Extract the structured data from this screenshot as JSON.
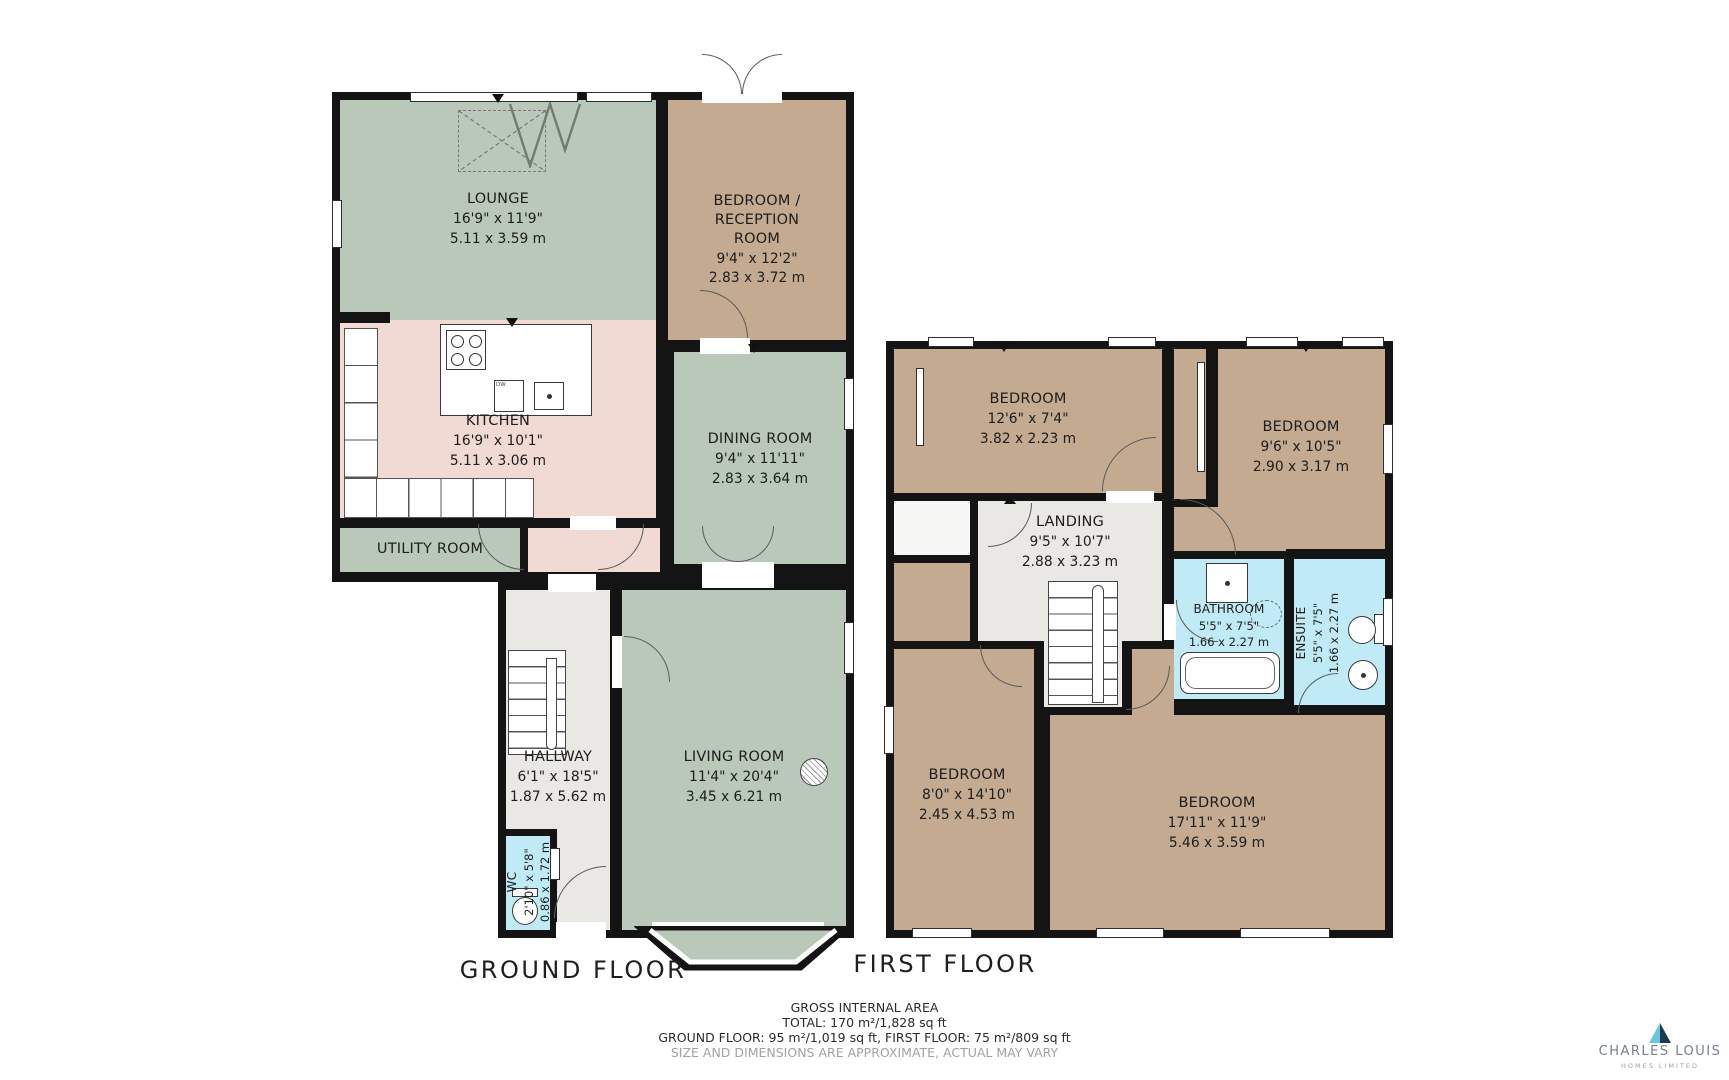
{
  "ground": {
    "floor_label": "GROUND FLOOR",
    "rooms": [
      {
        "name": "LOUNGE",
        "ft": "16'9\" x 11'9\"",
        "m": "5.11 x 3.59 m"
      },
      {
        "name": "BEDROOM / RECEPTION ROOM",
        "ft": "9'4\" x 12'2\"",
        "m": "2.83 x 3.72 m"
      },
      {
        "name": "KITCHEN",
        "ft": "16'9\" x 10'1\"",
        "m": "5.11 x 3.06 m"
      },
      {
        "name": "DINING ROOM",
        "ft": "9'4\" x 11'11\"",
        "m": "2.83 x 3.64 m"
      },
      {
        "name": "UTILITY ROOM",
        "ft": "",
        "m": ""
      },
      {
        "name": "HALLWAY",
        "ft": "6'1\" x 18'5\"",
        "m": "1.87 x 5.62 m"
      },
      {
        "name": "WC",
        "ft": "2'10\" x 5'8\"",
        "m": "0.86 x 1.72 m"
      },
      {
        "name": "LIVING ROOM",
        "ft": "11'4\" x 20'4\"",
        "m": "3.45 x 6.21 m"
      }
    ]
  },
  "first": {
    "floor_label": "FIRST FLOOR",
    "rooms": [
      {
        "name": "BEDROOM",
        "ft": "12'6\" x 7'4\"",
        "m": "3.82 x 2.23 m"
      },
      {
        "name": "BEDROOM",
        "ft": "9'6\" x 10'5\"",
        "m": "2.90 x 3.17 m"
      },
      {
        "name": "LANDING",
        "ft": "9'5\" x 10'7\"",
        "m": "2.88 x 3.23 m"
      },
      {
        "name": "BATHROOM",
        "ft": "5'5\" x 7'5\"",
        "m": "1.66 x 2.27 m"
      },
      {
        "name": "ENSUITE",
        "ft": "5'5\" x 7'5\"",
        "m": "1.66 x 2.27 m"
      },
      {
        "name": "BEDROOM",
        "ft": "8'0\" x 14'10\"",
        "m": "2.45 x 4.53 m"
      },
      {
        "name": "BEDROOM",
        "ft": "17'11\" x 11'9\"",
        "m": "5.46 x 3.59 m"
      }
    ]
  },
  "fixtures": {
    "dishwasher_label": "DW"
  },
  "footer": {
    "title": "GROSS INTERNAL AREA",
    "total": "TOTAL: 170 m²/1,828 sq ft",
    "floors": "GROUND FLOOR: 95 m²/1,019 sq ft, FIRST FLOOR: 75 m²/809 sq ft",
    "disclaimer": "SIZE AND DIMENSIONS ARE APPROXIMATE, ACTUAL MAY VARY"
  },
  "brand": {
    "name": "CHARLES LOUIS",
    "subtitle": "HOMES LIMITED"
  },
  "colors": {
    "wall": "#141414",
    "room_green": "#b9c8b8",
    "room_pink": "#f0dad3",
    "room_brown": "#c3aa91",
    "room_blue": "#bfeaf6",
    "room_gray": "#eae8e4",
    "logo_teal": "#6ac6d8",
    "logo_navy": "#1f3b53"
  }
}
